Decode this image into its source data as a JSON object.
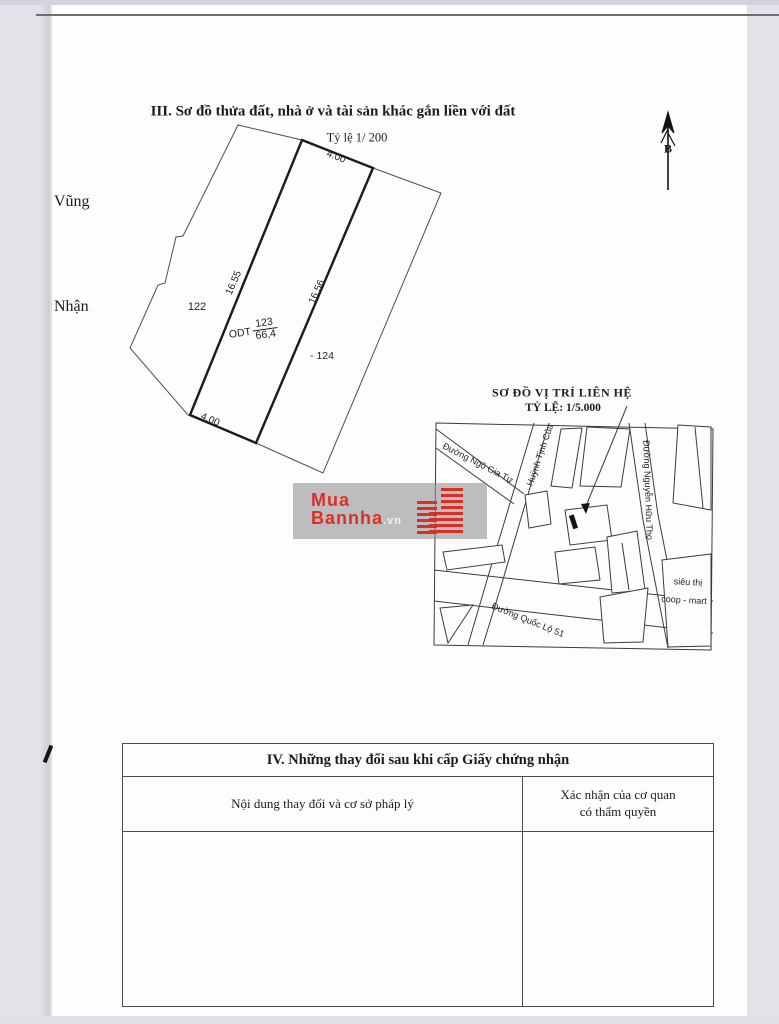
{
  "doc": {
    "section3_title": "III. Sơ đồ thửa đất, nhà ở và tài sản khác gắn liền với đất",
    "plot_scale": "Tỷ lệ 1/ 200",
    "margin_word_top": "Vũng",
    "margin_word_bottom": "Nhận",
    "north_label": "B",
    "plot": {
      "top_length": "4.00",
      "bottom_length": "4.00",
      "left_length": "16.55",
      "right_length": "16.56",
      "parcel_left": "122",
      "parcel_right": "- 124",
      "parcel_center_prefix": "ODT",
      "parcel_center_numerator": "123",
      "parcel_center_denominator": "66,4"
    },
    "map": {
      "title": "SƠ ĐỒ VỊ TRÍ LIÊN HỆ",
      "scale": "TỶ LỆ: 1/5.000",
      "street_ngo_gia_tu": "Đường Ngô Gia Tự",
      "street_huynh_tinh_cua": "Huỳnh Tịnh Của",
      "street_nguyen_huu_tho": "Đường Nguyễn Hữu Thọ",
      "street_quoc_lo_51": "Đường Quốc Lộ 51",
      "poi_sieu_thi_line1": "siêu thị",
      "poi_sieu_thi_line2": "coop - mart"
    },
    "watermark": {
      "line1": "Mua",
      "line2": "Bannha",
      "tld": ".vn"
    },
    "section4": {
      "title": "IV. Những thay đổi sau khi cấp Giấy chứng nhận",
      "col_left": "Nội dung thay đổi và cơ sở pháp lý",
      "col_right_line1": "Xác nhận của cơ quan",
      "col_right_line2": "có thẩm quyền"
    }
  }
}
